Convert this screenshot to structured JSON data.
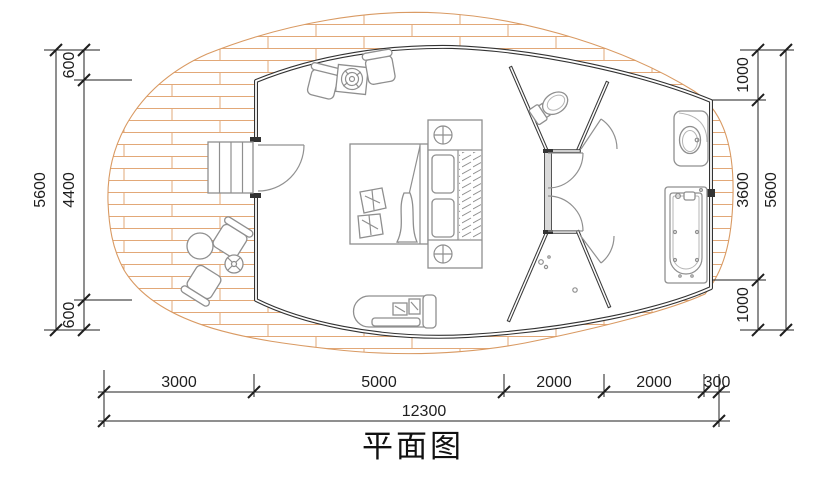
{
  "title": {
    "text": "平面图"
  },
  "colors": {
    "wall": "#333333",
    "partition": "#3a3a3a",
    "furniture": "#8f8f8f",
    "door": "#909090",
    "deck_line": "#e2a878",
    "deck_edge": "#d99a63",
    "dimension": "#1f1f1f"
  },
  "dims": {
    "left": {
      "total": "5600",
      "segments": [
        "600",
        "4400",
        "600"
      ]
    },
    "right": {
      "total": "5600",
      "segments": [
        "1000",
        "3600",
        "1000"
      ]
    },
    "bottom": {
      "total": "12300",
      "segments": [
        "3000",
        "5000",
        "2000",
        "2000",
        "300"
      ]
    }
  }
}
